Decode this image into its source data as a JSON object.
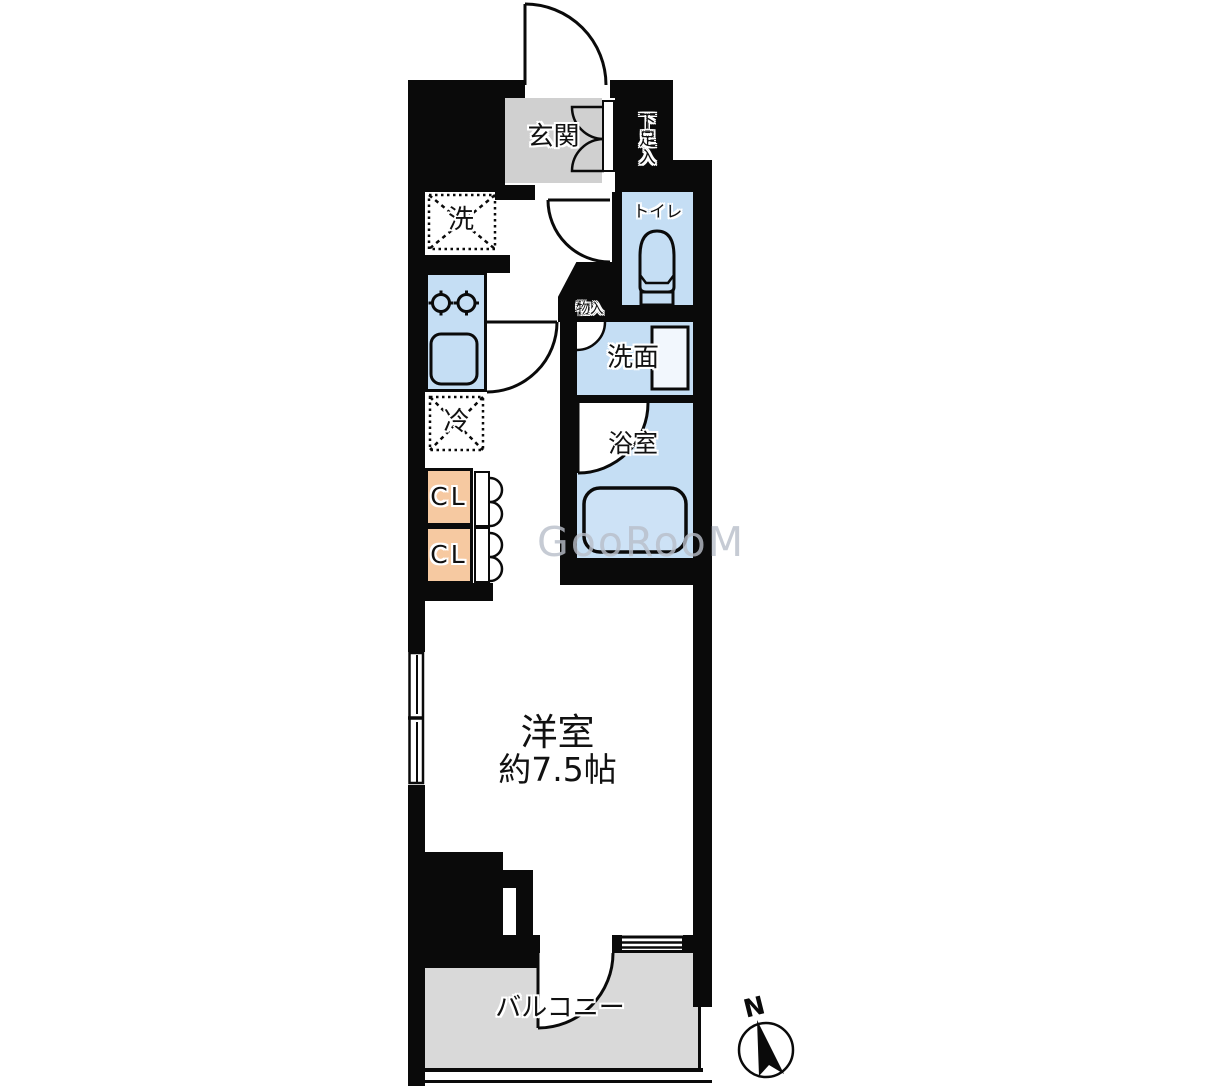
{
  "floorplan": {
    "watermark": "GooRooM",
    "compass": {
      "label": "N"
    },
    "rooms": {
      "genkan": {
        "label": "玄関"
      },
      "shoe_cabinet": {
        "label": "下足入"
      },
      "toilet": {
        "label": "トイレ"
      },
      "washer_space": {
        "label": "洗"
      },
      "refrigerator_space": {
        "label": "冷"
      },
      "storage": {
        "label": "物入"
      },
      "washroom": {
        "label": "洗面"
      },
      "bathroom": {
        "label": "浴室"
      },
      "closet_upper": {
        "label": "CL"
      },
      "closet_lower": {
        "label": "CL"
      },
      "western_room": {
        "label": "洋室",
        "size": "約7.5帖"
      },
      "balcony": {
        "label": "バルコニー"
      }
    },
    "colors": {
      "wall": "#0a0a0a",
      "wet_area_blue": "#c5def4",
      "closet_orange": "#f6c9a1",
      "genkan_gray": "#d0d0d0",
      "balcony_gray": "#d9d9d9",
      "watermark_gray": "#b9bfca"
    }
  }
}
